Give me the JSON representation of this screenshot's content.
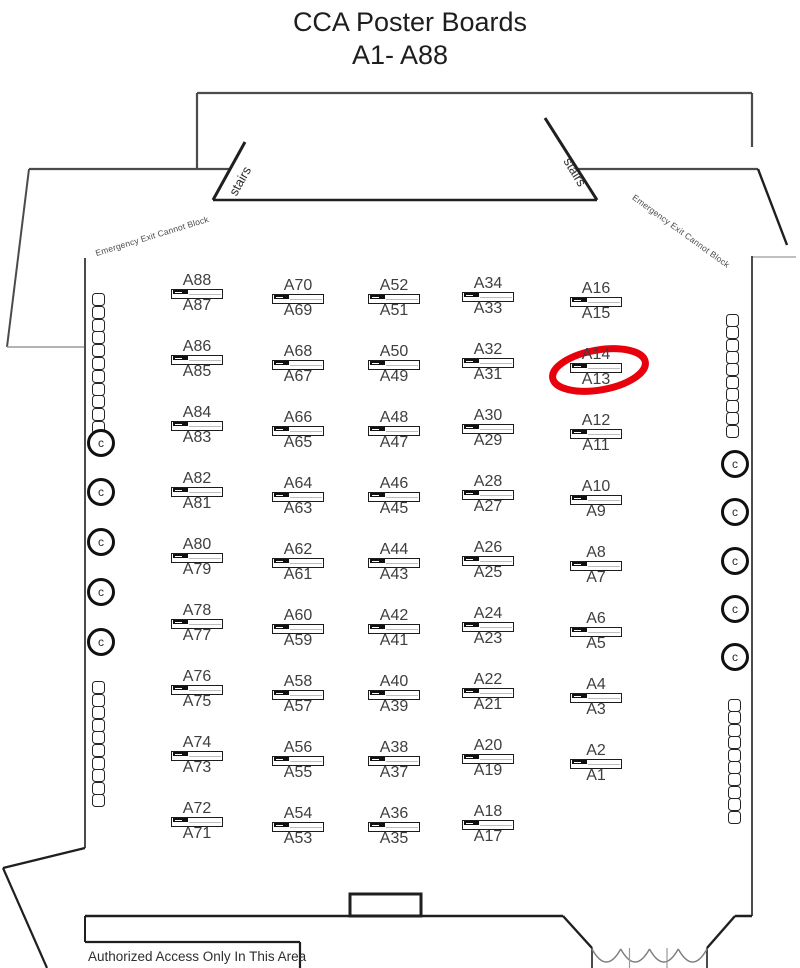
{
  "title": {
    "line1": "CCA Poster Boards",
    "line2": "A1- A88"
  },
  "annotations": {
    "stairs_left": "stairs",
    "stairs_right": "stairs",
    "emergency_left": "Emergency Exit Cannot Block",
    "emergency_right": "Emergency Exit Cannot Block",
    "authorized": "Authorized Access Only In This Area"
  },
  "colors": {
    "wall_dark": "#1f1f1f",
    "wall_mid": "#4b4b4b",
    "wall_light": "#9a9a9a",
    "label": "#3e3e3e",
    "highlight": "#e8000d"
  },
  "boards": {
    "icon": {
      "w": 52,
      "h": 10
    },
    "row_spacing": 66,
    "columns": [
      {
        "x": 197,
        "base_y": 289,
        "pairs": [
          [
            "A88",
            "A87"
          ],
          [
            "A86",
            "A85"
          ],
          [
            "A84",
            "A83"
          ],
          [
            "A82",
            "A81"
          ],
          [
            "A80",
            "A79"
          ],
          [
            "A78",
            "A77"
          ],
          [
            "A76",
            "A75"
          ],
          [
            "A74",
            "A73"
          ],
          [
            "A72",
            "A71"
          ]
        ]
      },
      {
        "x": 298,
        "base_y": 294,
        "pairs": [
          [
            "A70",
            "A69"
          ],
          [
            "A68",
            "A67"
          ],
          [
            "A66",
            "A65"
          ],
          [
            "A64",
            "A63"
          ],
          [
            "A62",
            "A61"
          ],
          [
            "A60",
            "A59"
          ],
          [
            "A58",
            "A57"
          ],
          [
            "A56",
            "A55"
          ],
          [
            "A54",
            "A53"
          ]
        ]
      },
      {
        "x": 394,
        "base_y": 294,
        "pairs": [
          [
            "A52",
            "A51"
          ],
          [
            "A50",
            "A49"
          ],
          [
            "A48",
            "A47"
          ],
          [
            "A46",
            "A45"
          ],
          [
            "A44",
            "A43"
          ],
          [
            "A42",
            "A41"
          ],
          [
            "A40",
            "A39"
          ],
          [
            "A38",
            "A37"
          ],
          [
            "A36",
            "A35"
          ]
        ]
      },
      {
        "x": 488,
        "base_y": 292,
        "pairs": [
          [
            "A34",
            "A33"
          ],
          [
            "A32",
            "A31"
          ],
          [
            "A30",
            "A29"
          ],
          [
            "A28",
            "A27"
          ],
          [
            "A26",
            "A25"
          ],
          [
            "A24",
            "A23"
          ],
          [
            "A22",
            "A21"
          ],
          [
            "A20",
            "A19"
          ],
          [
            "A18",
            "A17"
          ]
        ]
      },
      {
        "x": 596,
        "base_y": 297,
        "pairs": [
          [
            "A16",
            "A15"
          ],
          [
            "A14",
            "A13"
          ],
          [
            "A12",
            "A11"
          ],
          [
            "A10",
            "A9"
          ],
          [
            "A8",
            "A7"
          ],
          [
            "A6",
            "A5"
          ],
          [
            "A4",
            "A3"
          ],
          [
            "A2",
            "A1"
          ]
        ]
      }
    ]
  },
  "highlight": {
    "target": "A14/A13",
    "cx": 599,
    "cy": 370,
    "rx": 47,
    "ry": 20,
    "rotate_deg": -10,
    "stroke_width": 7
  },
  "furniture": {
    "chair_stacks": [
      {
        "side": "left-top",
        "x": 92,
        "y": 293,
        "count": 11,
        "dy": 12.8
      },
      {
        "side": "left-bottom",
        "x": 92,
        "y": 681,
        "count": 10,
        "dy": 12.6
      },
      {
        "side": "right-top",
        "x": 726,
        "y": 314,
        "count": 10,
        "dy": 12.3
      },
      {
        "side": "right-bottom",
        "x": 728,
        "y": 699,
        "count": 10,
        "dy": 12.4
      }
    ],
    "column_circles": {
      "glyph": "c",
      "left": {
        "x": 101,
        "ys": [
          443,
          492,
          542,
          592,
          642
        ]
      },
      "right": {
        "x": 735,
        "ys": [
          464,
          512,
          561,
          609,
          657
        ]
      }
    }
  },
  "floorplan": {
    "walls": [
      [
        197,
        93,
        752,
        93,
        2.2,
        "mid"
      ],
      [
        197,
        93,
        197,
        169,
        2.2,
        "mid"
      ],
      [
        752,
        93,
        752,
        147,
        2.2,
        "mid"
      ],
      [
        29,
        169,
        230,
        169,
        2.2,
        "mid"
      ],
      [
        577,
        169,
        758,
        169,
        2.2,
        "mid"
      ],
      [
        29,
        169,
        7,
        347,
        2,
        "mid"
      ],
      [
        7,
        347,
        85,
        347,
        1.4,
        "light"
      ],
      [
        758,
        169,
        787,
        245,
        2.4,
        "dark"
      ],
      [
        751,
        257,
        796,
        257,
        1.2,
        "light"
      ],
      [
        245,
        142,
        213,
        200,
        3,
        "dark"
      ],
      [
        213,
        200,
        597,
        200,
        2.6,
        "dark"
      ],
      [
        545,
        118,
        597,
        200,
        3,
        "dark"
      ],
      [
        85,
        258,
        85,
        848,
        2,
        "mid"
      ],
      [
        752,
        256,
        752,
        916,
        2,
        "mid"
      ],
      [
        85,
        848,
        3,
        868,
        2.2,
        "dark"
      ],
      [
        3,
        868,
        47,
        968,
        2.2,
        "dark"
      ],
      [
        85,
        916,
        563,
        916,
        2.4,
        "dark"
      ],
      [
        563,
        916,
        592,
        948,
        2.4,
        "dark"
      ],
      [
        592,
        948,
        592,
        968,
        2,
        "mid"
      ],
      [
        735,
        916,
        707,
        948,
        2.4,
        "dark"
      ],
      [
        707,
        948,
        707,
        968,
        2,
        "mid"
      ],
      [
        735,
        916,
        752,
        916,
        2.4,
        "dark"
      ],
      [
        85,
        916,
        85,
        942,
        2,
        "dark"
      ],
      [
        85,
        942,
        300,
        942,
        2.2,
        "dark"
      ],
      [
        300,
        942,
        300,
        968,
        2.2,
        "dark"
      ]
    ],
    "podium": {
      "x": 350,
      "y": 894,
      "w": 71,
      "h": 22,
      "stroke_width": 3
    },
    "door": {
      "x1": 592,
      "x2": 707,
      "y": 949,
      "dip": 26,
      "scallops": 4,
      "ticks": [
        629.5,
        667
      ]
    }
  }
}
